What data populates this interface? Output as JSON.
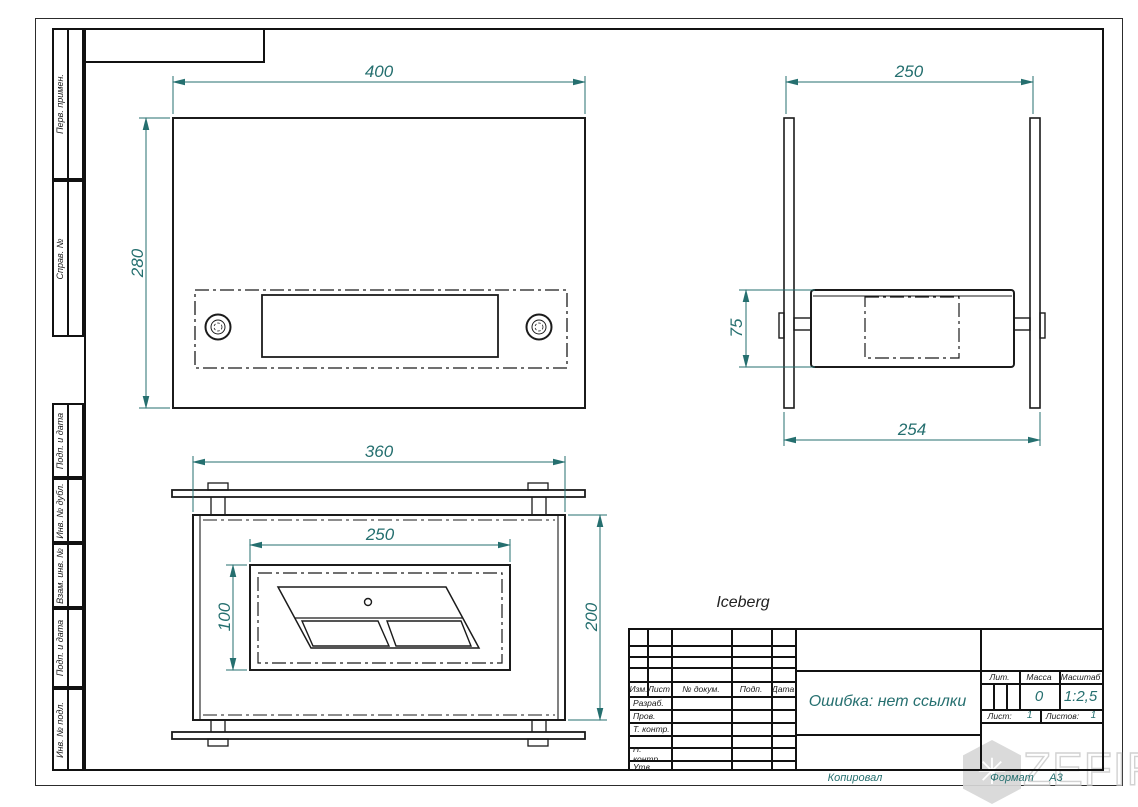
{
  "sheet": {
    "product_label": "Iceberg",
    "footer": {
      "copied_by": "Копировал",
      "format_label": "Формат",
      "format_value": "А3"
    },
    "watermark_text": "ZEFIRE"
  },
  "colors": {
    "line": "#1b1b1b",
    "dimension": "#256f6f",
    "watermark": "#d7d7d7"
  },
  "views": {
    "front": {
      "dim_width": "400",
      "dim_height": "280"
    },
    "side": {
      "dim_width": "250",
      "dim_height": "75",
      "dim_outer": "254"
    },
    "top": {
      "dim_width": "360",
      "dim_inner_width": "250",
      "dim_inner_depth": "100",
      "dim_depth": "200"
    }
  },
  "sidebar": {
    "items": [
      "Перв. примен.",
      "Справ. №",
      "Подп. и дата",
      "Инв. № дубл.",
      "Взам. инв. №",
      "Подп. и дата",
      "Инв. № подл."
    ]
  },
  "title_block": {
    "header_cols": [
      "Изм.",
      "Лист",
      "№ докум.",
      "Подп.",
      "Дата"
    ],
    "signature_rows": [
      "Разраб.",
      "Пров.",
      "Т. контр.",
      "Н. контр.",
      "Утв."
    ],
    "doc_name": "Ошибка: нет ссылки",
    "lit_label": "Лит.",
    "mass_label": "Масса",
    "scale_label": "Масштаб",
    "mass_value": "0",
    "scale_value": "1:2,5",
    "sheet_label": "Лист:",
    "sheet_value": "1",
    "sheets_label": "Листов:",
    "sheets_value": "1"
  }
}
